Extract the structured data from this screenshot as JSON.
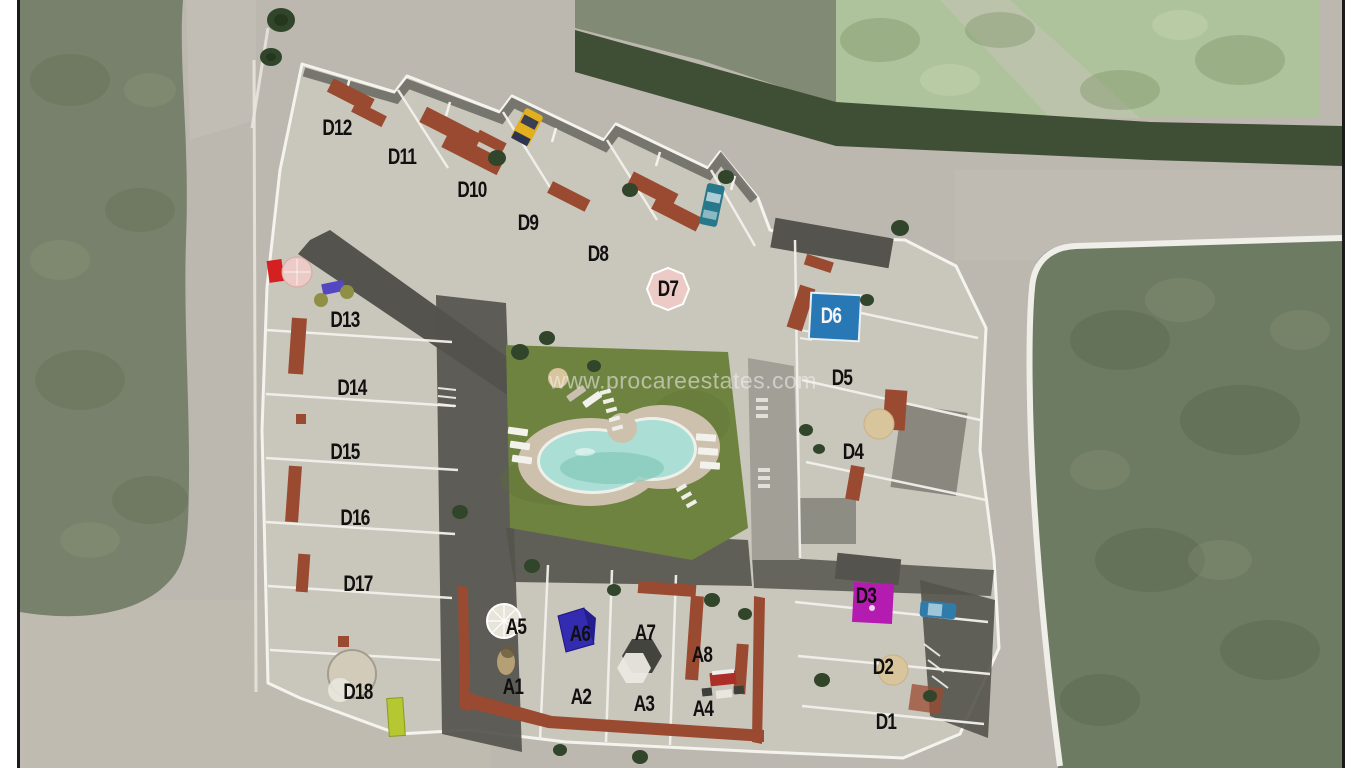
{
  "title": "Residential development site plan (aerial view)",
  "watermark": {
    "text": "www.procareestates.com"
  },
  "labels": [
    {
      "text": "D12",
      "x": 337,
      "y": 128,
      "color": "#101010"
    },
    {
      "text": "D11",
      "x": 402,
      "y": 157,
      "color": "#101010"
    },
    {
      "text": "D10",
      "x": 472,
      "y": 190,
      "color": "#101010"
    },
    {
      "text": "D9",
      "x": 528,
      "y": 223,
      "color": "#101010"
    },
    {
      "text": "D8",
      "x": 598,
      "y": 254,
      "color": "#101010"
    },
    {
      "text": "D7",
      "x": 668,
      "y": 289,
      "color": "#101010"
    },
    {
      "text": "D6",
      "x": 831,
      "y": 316,
      "color": "#f5f5f5"
    },
    {
      "text": "D5",
      "x": 842,
      "y": 378,
      "color": "#101010"
    },
    {
      "text": "D4",
      "x": 853,
      "y": 452,
      "color": "#101010"
    },
    {
      "text": "D3",
      "x": 866,
      "y": 596,
      "color": "#101010"
    },
    {
      "text": "D2",
      "x": 883,
      "y": 667,
      "color": "#101010"
    },
    {
      "text": "D1",
      "x": 886,
      "y": 722,
      "color": "#101010"
    },
    {
      "text": "D13",
      "x": 345,
      "y": 320,
      "color": "#101010"
    },
    {
      "text": "D14",
      "x": 352,
      "y": 388,
      "color": "#101010"
    },
    {
      "text": "D15",
      "x": 345,
      "y": 452,
      "color": "#101010"
    },
    {
      "text": "D16",
      "x": 355,
      "y": 518,
      "color": "#101010"
    },
    {
      "text": "D17",
      "x": 358,
      "y": 584,
      "color": "#101010"
    },
    {
      "text": "D18",
      "x": 358,
      "y": 692,
      "color": "#101010"
    },
    {
      "text": "A5",
      "x": 516,
      "y": 627,
      "color": "#101010"
    },
    {
      "text": "A6",
      "x": 580,
      "y": 634,
      "color": "#101010"
    },
    {
      "text": "A7",
      "x": 645,
      "y": 633,
      "color": "#101010"
    },
    {
      "text": "A8",
      "x": 702,
      "y": 655,
      "color": "#101010"
    },
    {
      "text": "A1",
      "x": 513,
      "y": 687,
      "color": "#101010"
    },
    {
      "text": "A2",
      "x": 581,
      "y": 697,
      "color": "#101010"
    },
    {
      "text": "A3",
      "x": 644,
      "y": 704,
      "color": "#101010"
    },
    {
      "text": "A4",
      "x": 703,
      "y": 709,
      "color": "#101010"
    }
  ],
  "colors": {
    "road": "#bcb8af",
    "field_left": "#77816b",
    "field_right": "#6e7b63",
    "patch_topright": "#aec29b",
    "hedge": "#3f4f35",
    "dev_base": "#c9c6bb",
    "dev_outline": "#f4f3ee",
    "street_dark": "#54534d",
    "lawn": "#6f8340",
    "deck": "#cdc1ae",
    "pool_water": "#abded4",
    "pool_water_deep": "#84c9bb",
    "terracotta": "#9a4a30",
    "rooftop_pool_blue": "#2878b6",
    "rooftop_pool_magenta": "#b41bb0",
    "car_yellow": "#e2af1f",
    "car_teal": "#27788a",
    "car_blue": "#2f7cab",
    "umbrella_red": "#d42020",
    "umbrella_pink": "#eccbc6",
    "parasol_tan": "#d9c59c",
    "parasol_blue": "#332bb0",
    "lounger_purple": "#5348c2",
    "lounger_lime": "#b5c832",
    "tree_green": "#31452a",
    "border_line": "#1a1a1a"
  }
}
